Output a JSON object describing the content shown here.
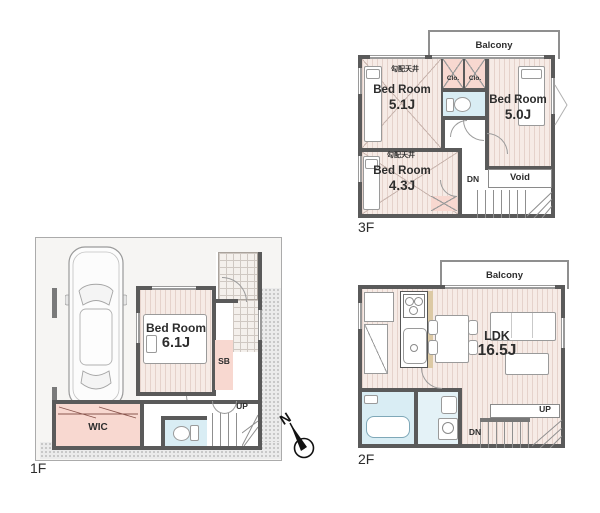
{
  "colors": {
    "wall": "#5a5a5a",
    "floor_bg": "#f6ebe6",
    "floor_stripe": "#e5d2cb",
    "closet_pink": "#f8d8d0",
    "wet_area_blue": "#d9edf4",
    "counter_tan": "#dcc9a4",
    "site_stipple": "#ebebeb"
  },
  "floor3": {
    "label": "3F",
    "balcony": "Balcony",
    "bedroom_nw": {
      "ceiling": "勾配天井",
      "name": "Bed Room",
      "size": "5.1J"
    },
    "bedroom_e": {
      "name": "Bed Room",
      "size": "5.0J"
    },
    "bedroom_sw": {
      "ceiling": "勾配天井",
      "name": "Bed Room",
      "size": "4.3J"
    },
    "closet_left": "Clo.",
    "closet_right": "Clo.",
    "void": "Void",
    "stairs_down": "DN"
  },
  "floor2": {
    "label": "2F",
    "balcony": "Balcony",
    "ldk": {
      "name": "LDK",
      "size": "16.5J"
    },
    "stairs_up": "UP",
    "stairs_down": "DN"
  },
  "floor1": {
    "label": "1F",
    "bedroom": {
      "name": "Bed Room",
      "size": "6.1J"
    },
    "wic": "WIC",
    "shoe_box": "SB",
    "stairs_up": "UP"
  },
  "compass": {
    "north": "N"
  }
}
